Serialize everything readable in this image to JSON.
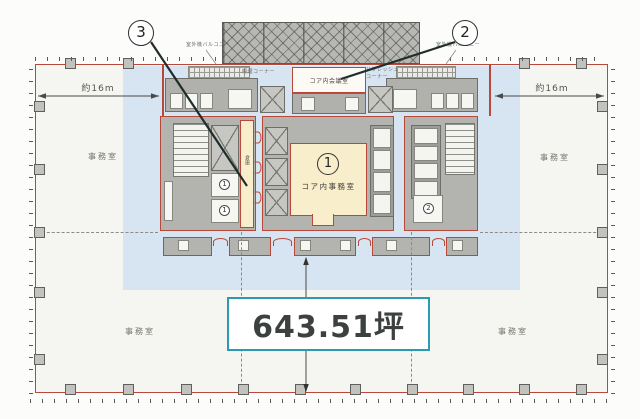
{
  "plan": {
    "area_box": "643.51坪",
    "callouts": {
      "c1": "1",
      "c2": "2",
      "c3": "3"
    },
    "rooms": {
      "core_office": "コア内事務室",
      "core_meeting": "コア内会議室",
      "office": "事務室",
      "storage": "倉庫",
      "smoking_corner": "喫煙コーナー",
      "refresh_corner_l1": "リフレッシュ",
      "refresh_corner_l2": "コーナー",
      "outdoor_unit_balcony": "室外機バルコニー",
      "mini_1": "1",
      "mini_2": "2"
    },
    "dimensions": {
      "left": "約16m",
      "right": "約16m"
    },
    "colors": {
      "outline_red": "#b8483a",
      "highlight_blue": "#d7e4f1",
      "room_cream": "#f8eecb",
      "area_box_border": "#2b9ab3",
      "wall_gray": "#b0b0ac"
    }
  }
}
